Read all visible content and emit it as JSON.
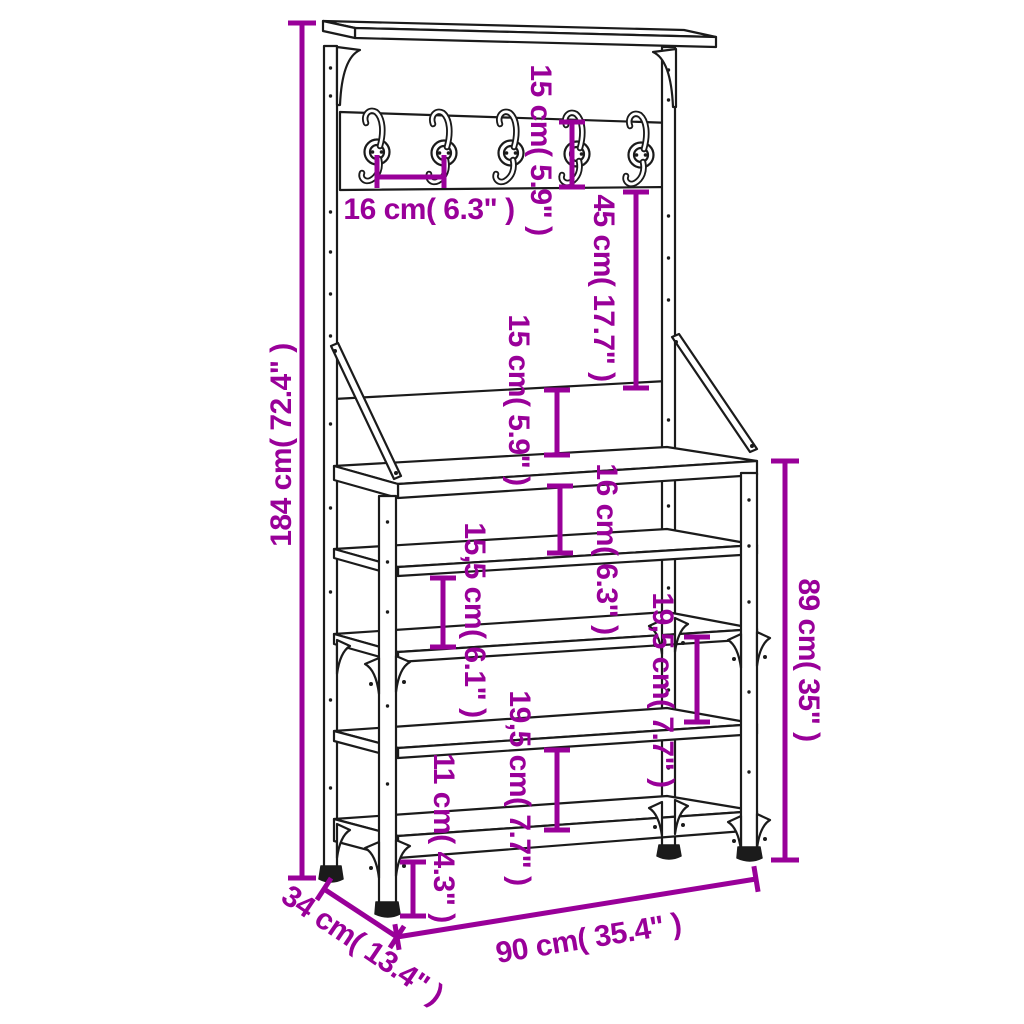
{
  "diagram": {
    "kind": "furniture-dimension-diagram",
    "subject": "clothes-rack-with-hooks-and-shoe-shelves",
    "background_color": "#ffffff",
    "line_color": "#1b1b1b",
    "accent_color": "#990099",
    "hook_count": 5,
    "shelf_levels": 5,
    "dims": {
      "total_height": {
        "label": "184 cm( 72.4\" )",
        "cm": 184,
        "inches": 72.4
      },
      "hook_panel_height": {
        "label": "15 cm( 5.9\" )",
        "cm": 15,
        "inches": 5.9
      },
      "hook_spacing": {
        "label": "16 cm( 6.3\" )",
        "cm": 16,
        "inches": 6.3
      },
      "panel_to_bench": {
        "label": "45 cm( 17.7\" )",
        "cm": 45,
        "inches": 17.7
      },
      "bench_back_height": {
        "label": "15 cm( 5.9\" )",
        "cm": 15,
        "inches": 5.9
      },
      "bench_to_shelf": {
        "label": "16 cm( 6.3\" )",
        "cm": 16,
        "inches": 6.3
      },
      "shelf_gap_mid": {
        "label": "15,5 cm( 6.1\" )",
        "cm": 15.5,
        "inches": 6.1
      },
      "shelf_gap_right": {
        "label": "19,5 cm( 7.7\" )",
        "cm": 19.5,
        "inches": 7.7
      },
      "shelf_gap_center": {
        "label": "19,5 cm( 7.7\" )",
        "cm": 19.5,
        "inches": 7.7
      },
      "ground_clearance": {
        "label": "11 cm( 4.3\" )",
        "cm": 11,
        "inches": 4.3
      },
      "rack_height": {
        "label": "89 cm( 35\" )",
        "cm": 89,
        "inches": 35
      },
      "width": {
        "label": "90 cm( 35.4\" )",
        "cm": 90,
        "inches": 35.4
      },
      "depth": {
        "label": "34 cm( 13.4\" )",
        "cm": 34,
        "inches": 13.4
      }
    }
  }
}
